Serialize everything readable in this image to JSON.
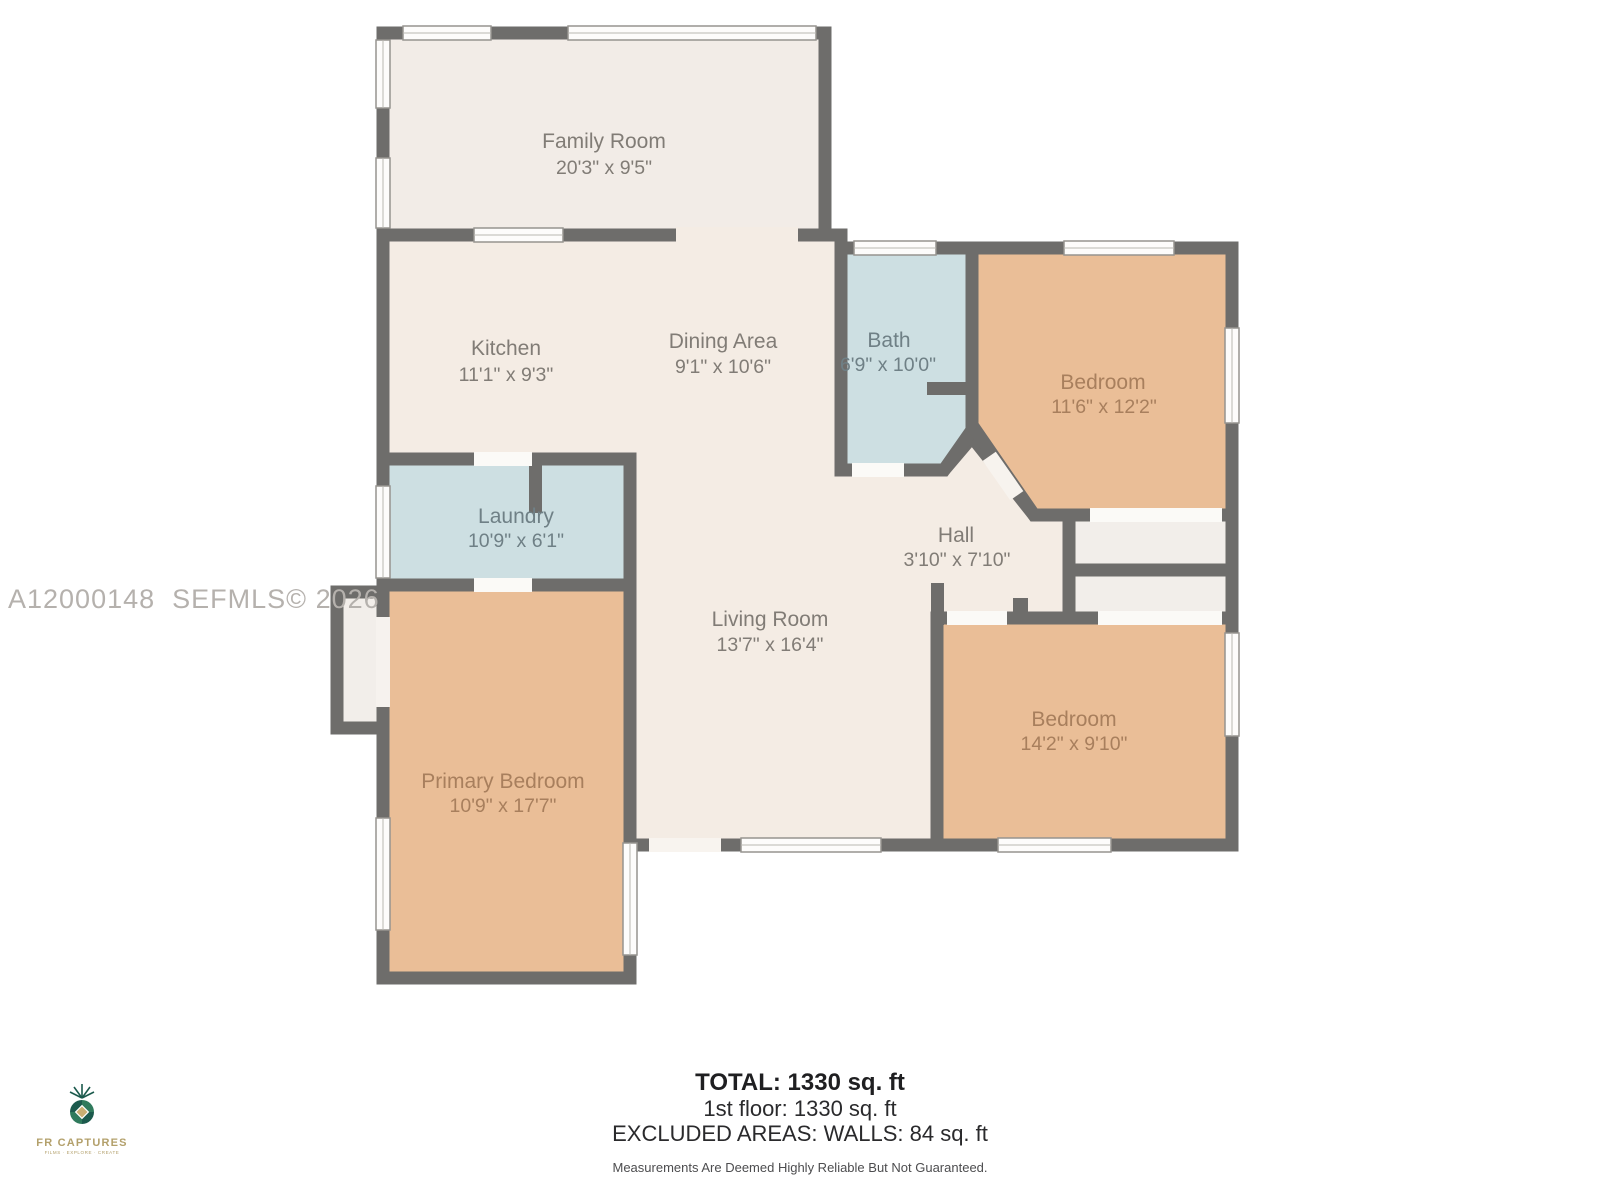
{
  "watermark": "A12000148  SEFMLS© 2026",
  "rooms": [
    {
      "name": "Family Room",
      "dims": "20'3\" x 9'5\""
    },
    {
      "name": "Kitchen",
      "dims": "11'1\" x 9'3\""
    },
    {
      "name": "Dining Area",
      "dims": "9'1\" x 10'6\""
    },
    {
      "name": "Bath",
      "dims": "6'9\" x 10'0\""
    },
    {
      "name": "Bedroom",
      "dims": "11'6\" x 12'2\""
    },
    {
      "name": "Laundry",
      "dims": "10'9\" x 6'1\""
    },
    {
      "name": "Hall",
      "dims": "3'10\" x 7'10\""
    },
    {
      "name": "Living Room",
      "dims": "13'7\" x 16'4\""
    },
    {
      "name": "Primary Bedroom",
      "dims": "10'9\" x 17'7\""
    },
    {
      "name": "Bedroom",
      "dims": "14'2\" x 9'10\""
    }
  ],
  "summary": {
    "total": "TOTAL: 1330 sq. ft",
    "floor1": "1st floor: 1330 sq. ft",
    "excluded": "EXCLUDED AREAS: WALLS: 84 sq. ft",
    "disclaimer": "Measurements Are Deemed Highly Reliable But Not Guaranteed."
  },
  "logo": {
    "brand": "FR CAPTURES",
    "tagline": "FILMS · EXPLORE · CREATE"
  },
  "colors": {
    "wall": "#6e6d6b",
    "room_cream": "#f4ece4",
    "room_family": "#f2ece7",
    "room_blue": "#cddfe2",
    "room_tan": "#eabe97",
    "closet": "#f2eeea",
    "window_fill": "#fdfcfb"
  }
}
